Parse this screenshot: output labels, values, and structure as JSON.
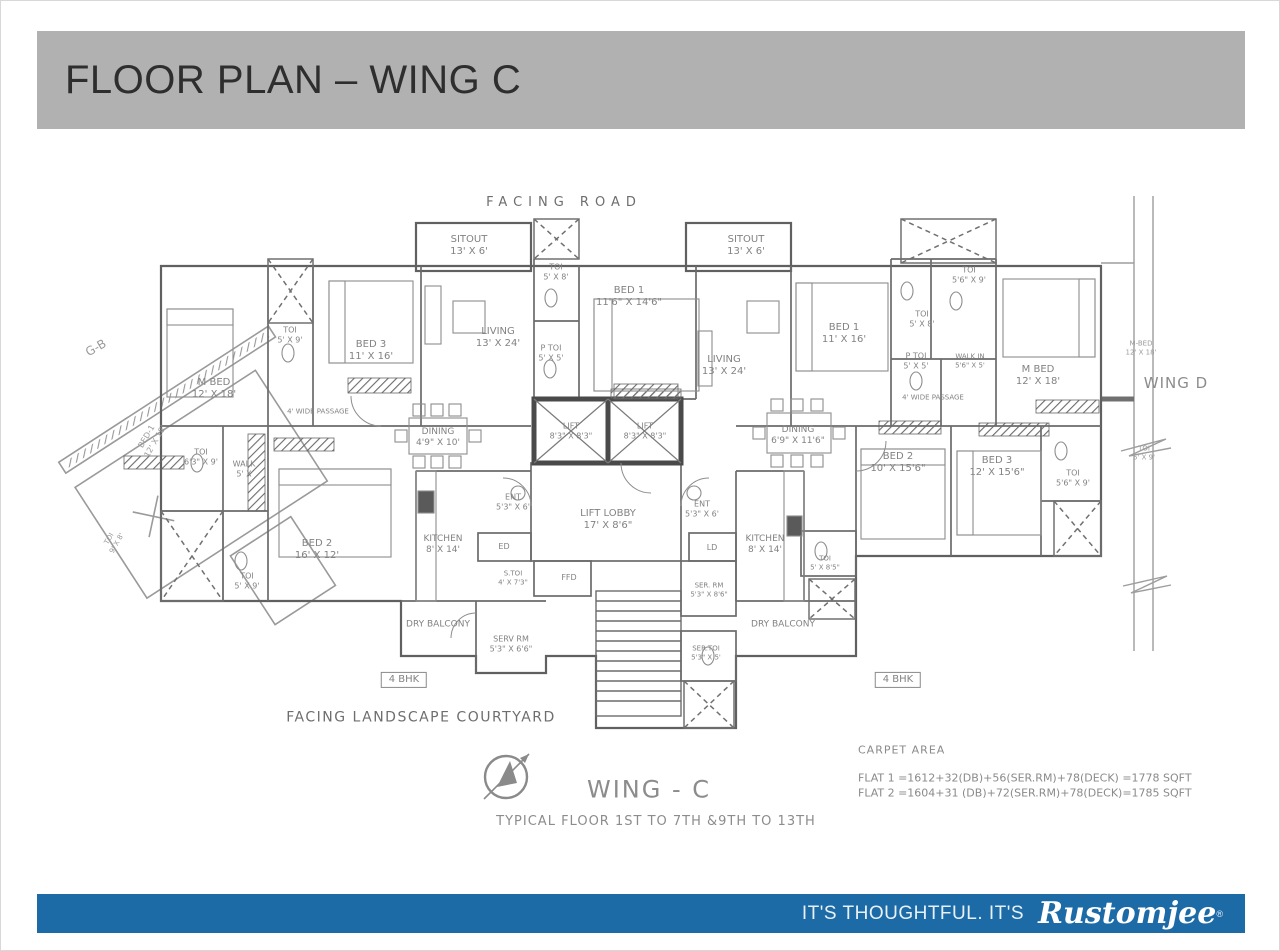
{
  "header": {
    "title": "FLOOR PLAN – WING C",
    "bg": "#b1b1b1"
  },
  "footer": {
    "tagline": "IT'S THOUGHTFUL. IT'S",
    "brand": "Rustomjee",
    "brand_mark": "®",
    "bg": "#1d6ba6"
  },
  "plan": {
    "line_color": "#606060",
    "labels": [
      {
        "id": "facing-road-label",
        "x": 563,
        "y": 202,
        "t": [
          "FACING ROAD"
        ],
        "fs": 13,
        "ls": 6,
        "color": "#6e6e6e"
      },
      {
        "id": "facing-courtyard-label",
        "x": 420,
        "y": 717,
        "t": [
          "FACING LANDSCAPE COURTYARD"
        ],
        "fs": 14,
        "ls": 1.5,
        "color": "#6e6e6e"
      },
      {
        "id": "wing-c-label",
        "x": 648,
        "y": 789,
        "t": [
          "WING - C"
        ],
        "fs": 24,
        "ls": 2,
        "color": "#8c8c8c"
      },
      {
        "id": "typical-floor-label",
        "x": 655,
        "y": 821,
        "t": [
          "TYPICAL FLOOR 1ST TO 7TH &9TH TO 13TH"
        ],
        "fs": 13,
        "ls": 1,
        "color": "#8c8c8c"
      },
      {
        "id": "carpet-area-title",
        "x": 857,
        "y": 749,
        "t": [
          "CARPET AREA"
        ],
        "fs": 11,
        "ls": 1,
        "align": "left",
        "color": "#8a8a8a"
      },
      {
        "id": "carpet-area-flat1",
        "x": 857,
        "y": 777,
        "t": [
          "FLAT 1 =1612+32(DB)+56(SER.RM)+78(DECK) =1778 SQFT"
        ],
        "fs": 11,
        "align": "left",
        "color": "#8a8a8a"
      },
      {
        "id": "carpet-area-flat2",
        "x": 857,
        "y": 792,
        "t": [
          "FLAT 2 =1604+31 (DB)+72(SER.RM)+78(DECK)=1785 SQFT"
        ],
        "fs": 11,
        "align": "left",
        "color": "#8a8a8a"
      },
      {
        "id": "wing-d-label",
        "x": 1175,
        "y": 382,
        "t": [
          "WING D"
        ],
        "fs": 15,
        "ls": 1,
        "color": "#8c8c8c"
      },
      {
        "id": "wing-d-mbed-label",
        "x": 1140,
        "y": 347,
        "t": [
          "M-BED",
          "12' X 18'"
        ],
        "fs": 7,
        "color": "#9a9a9a"
      },
      {
        "id": "wing-d-toi-label",
        "x": 1143,
        "y": 452,
        "t": [
          "TOI",
          "5' X 9'"
        ],
        "fs": 7,
        "color": "#9a9a9a"
      },
      {
        "id": "wing-b-label",
        "x": 95,
        "y": 347,
        "t": [
          "G-B"
        ],
        "fs": 12,
        "rot": -30,
        "color": "#9a9a9a"
      },
      {
        "id": "wing-b-bed1-label",
        "x": 150,
        "y": 438,
        "t": [
          "BED-1",
          "12' X 18'"
        ],
        "fs": 8,
        "rot": -60,
        "color": "#9a9a9a"
      },
      {
        "id": "wing-b-toi-label",
        "x": 112,
        "y": 540,
        "t": [
          "TOI",
          "9' X 8'"
        ],
        "fs": 7,
        "rot": -60,
        "color": "#9a9a9a"
      },
      {
        "id": "bhk-left-label",
        "x": 403,
        "y": 679,
        "t": [
          "4 BHK"
        ],
        "fs": 10,
        "box": true
      },
      {
        "id": "bhk-right-label",
        "x": 897,
        "y": 679,
        "t": [
          "4 BHK"
        ],
        "fs": 10,
        "box": true
      },
      {
        "id": "room-sitout-left",
        "x": 468,
        "y": 245,
        "t": [
          "SITOUT",
          "13' X 6'"
        ]
      },
      {
        "id": "room-toi-top-left",
        "x": 555,
        "y": 271,
        "t": [
          "TOI",
          "5' X 8'"
        ],
        "fs": 8
      },
      {
        "id": "room-living-left",
        "x": 497,
        "y": 337,
        "t": [
          "LIVING",
          "13' X 24'"
        ]
      },
      {
        "id": "room-bed1-left",
        "x": 628,
        "y": 296,
        "t": [
          "BED 1",
          "11'6\" X 14'6\""
        ]
      },
      {
        "id": "room-ptoi-left",
        "x": 550,
        "y": 352,
        "t": [
          "P TOI",
          "5' X 5'"
        ],
        "fs": 8
      },
      {
        "id": "room-mbed-left",
        "x": 213,
        "y": 388,
        "t": [
          "M BED",
          "12' X 18'"
        ]
      },
      {
        "id": "room-toi-5x9-left-top",
        "x": 289,
        "y": 334,
        "t": [
          "TOI",
          "5' X 9'"
        ],
        "fs": 8
      },
      {
        "id": "room-bed3-left",
        "x": 370,
        "y": 350,
        "t": [
          "BED 3",
          "11' X 16'"
        ]
      },
      {
        "id": "passage-left-label",
        "x": 317,
        "y": 411,
        "t": [
          "4' WIDE PASSAGE"
        ],
        "fs": 7
      },
      {
        "id": "room-dining-left",
        "x": 437,
        "y": 437,
        "t": [
          "DINING",
          "4'9\" X 10'"
        ],
        "fs": 9
      },
      {
        "id": "room-toi-63x9-left",
        "x": 200,
        "y": 456,
        "t": [
          "TOI",
          "6'3\" X 9'"
        ],
        "fs": 8
      },
      {
        "id": "room-walk-left",
        "x": 243,
        "y": 468,
        "t": [
          "WALK",
          "5' X"
        ],
        "fs": 8
      },
      {
        "id": "room-bed2-left",
        "x": 316,
        "y": 549,
        "t": [
          "BED 2",
          "16' X 12'"
        ]
      },
      {
        "id": "room-toi-5x9-left-bottom",
        "x": 246,
        "y": 580,
        "t": [
          "TOI",
          "5' X 9'"
        ],
        "fs": 8
      },
      {
        "id": "room-kitchen-left",
        "x": 442,
        "y": 544,
        "t": [
          "KITCHEN",
          "8' X 14'"
        ],
        "fs": 9
      },
      {
        "id": "duct-ed-label",
        "x": 503,
        "y": 546,
        "t": [
          "ED"
        ],
        "fs": 8
      },
      {
        "id": "room-stoi-left",
        "x": 512,
        "y": 577,
        "t": [
          "S.TOI",
          "4' X 7'3\""
        ],
        "fs": 7
      },
      {
        "id": "room-dry-balcony-left",
        "x": 437,
        "y": 624,
        "t": [
          "DRY BALCONY"
        ],
        "fs": 9
      },
      {
        "id": "room-serv-rm-left",
        "x": 510,
        "y": 643,
        "t": [
          "SERV RM",
          "5'3\" X 6'6\""
        ],
        "fs": 8
      },
      {
        "id": "room-lift-1",
        "x": 570,
        "y": 430,
        "t": [
          "LIFT",
          "8'3\" X 8'3\""
        ],
        "fs": 8
      },
      {
        "id": "room-lift-2",
        "x": 644,
        "y": 430,
        "t": [
          "LIFT",
          "8'3\" X 8'3\""
        ],
        "fs": 8
      },
      {
        "id": "room-ent-left",
        "x": 512,
        "y": 501,
        "t": [
          "ENT",
          "5'3\" X 6'"
        ],
        "fs": 8
      },
      {
        "id": "room-ent-right",
        "x": 701,
        "y": 508,
        "t": [
          "ENT",
          "5'3\" X 6'"
        ],
        "fs": 8
      },
      {
        "id": "room-lift-lobby",
        "x": 607,
        "y": 519,
        "t": [
          "LIFT LOBBY",
          "17' X 8'6\""
        ]
      },
      {
        "id": "duct-ffd-label",
        "x": 568,
        "y": 577,
        "t": [
          "FFD"
        ],
        "fs": 8
      },
      {
        "id": "room-ser-rm-center",
        "x": 708,
        "y": 589,
        "t": [
          "SER. RM",
          "5'3\" X 8'6\""
        ],
        "fs": 7
      },
      {
        "id": "room-ser-toi-center",
        "x": 705,
        "y": 652,
        "t": [
          "SER.TOI",
          "5'3\" X 5'"
        ],
        "fs": 7
      },
      {
        "id": "room-sitout-right",
        "x": 745,
        "y": 245,
        "t": [
          "SITOUT",
          "13' X 6'"
        ]
      },
      {
        "id": "room-living-right",
        "x": 723,
        "y": 365,
        "t": [
          "LIVING",
          "13' X 24'"
        ]
      },
      {
        "id": "room-bed1-right",
        "x": 843,
        "y": 333,
        "t": [
          "BED 1",
          "11' X 16'"
        ]
      },
      {
        "id": "room-toi-56x9-right-top",
        "x": 968,
        "y": 274,
        "t": [
          "TOI",
          "5'6\" X 9'"
        ],
        "fs": 8
      },
      {
        "id": "room-toi-5x8-right",
        "x": 921,
        "y": 318,
        "t": [
          "TOI",
          "5' X 8'"
        ],
        "fs": 8
      },
      {
        "id": "room-ptoi-right",
        "x": 915,
        "y": 360,
        "t": [
          "P TOI",
          "5' X 5'"
        ],
        "fs": 8
      },
      {
        "id": "room-walkin-right",
        "x": 969,
        "y": 360,
        "t": [
          "WALK IN",
          "5'6\" X 5'"
        ],
        "fs": 7
      },
      {
        "id": "room-mbed-right",
        "x": 1037,
        "y": 375,
        "t": [
          "M BED",
          "12' X 18'"
        ]
      },
      {
        "id": "passage-right-label",
        "x": 932,
        "y": 397,
        "t": [
          "4' WIDE PASSAGE"
        ],
        "fs": 7
      },
      {
        "id": "room-dining-right",
        "x": 797,
        "y": 435,
        "t": [
          "DINING",
          "6'9\" X 11'6\""
        ],
        "fs": 9
      },
      {
        "id": "room-bed2-right",
        "x": 897,
        "y": 462,
        "t": [
          "BED 2",
          "10' X 15'6\""
        ]
      },
      {
        "id": "room-bed3-right",
        "x": 996,
        "y": 466,
        "t": [
          "BED 3",
          "12' X 15'6\""
        ]
      },
      {
        "id": "room-toi-56x9-right-bottom",
        "x": 1072,
        "y": 477,
        "t": [
          "TOI",
          "5'6\" X 9'"
        ],
        "fs": 8
      },
      {
        "id": "room-kitchen-right",
        "x": 764,
        "y": 544,
        "t": [
          "KITCHEN",
          "8' X 14'"
        ],
        "fs": 9
      },
      {
        "id": "duct-ld-label",
        "x": 711,
        "y": 547,
        "t": [
          "LD"
        ],
        "fs": 8
      },
      {
        "id": "room-toi-right-small",
        "x": 824,
        "y": 562,
        "t": [
          "TOI",
          "5' X 8'5\""
        ],
        "fs": 7
      },
      {
        "id": "room-dry-balcony-right",
        "x": 782,
        "y": 624,
        "t": [
          "DRY BALCONY"
        ],
        "fs": 9
      }
    ]
  }
}
